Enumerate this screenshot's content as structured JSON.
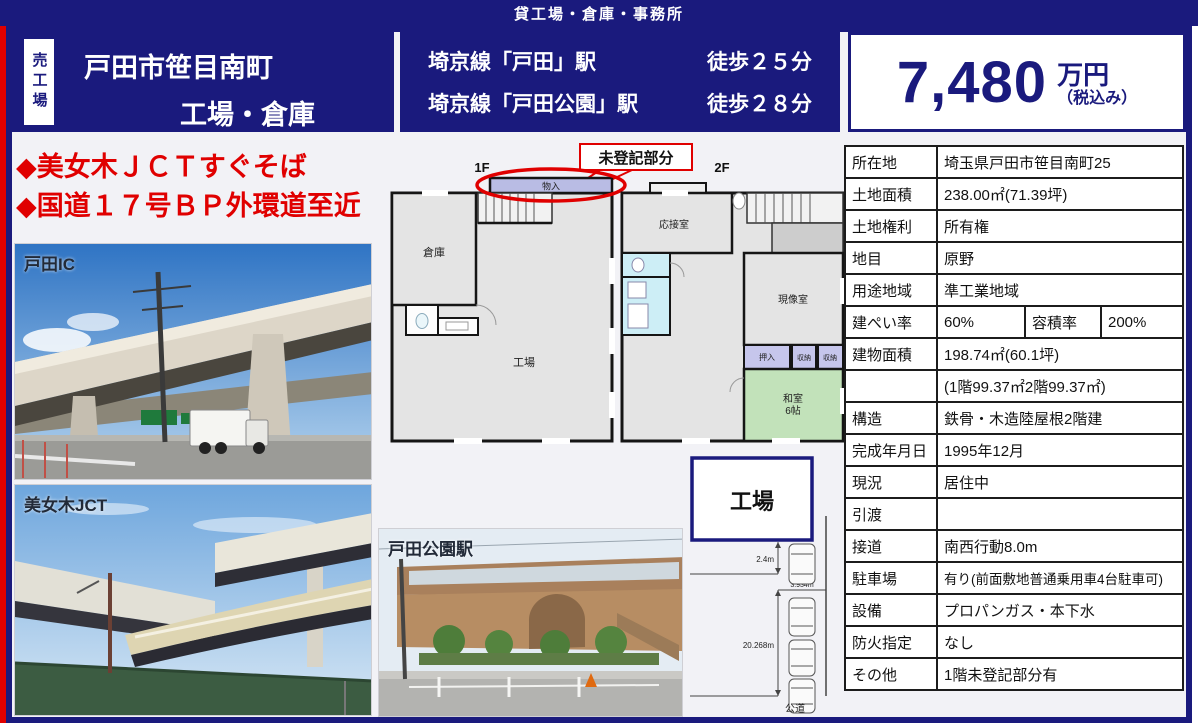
{
  "banner": {
    "text": "貸工場・倉庫・事務所"
  },
  "header": {
    "side_tag": "売工場",
    "title_line1": "戸田市笹目南町",
    "title_line2": "工場・倉庫",
    "stations": [
      {
        "line": "埼京線「戸田」駅",
        "walk": "徒歩２５分"
      },
      {
        "line": "埼京線「戸田公園」駅",
        "walk": "徒歩２８分"
      }
    ],
    "price": {
      "amount": "7,480",
      "unit": "万円",
      "tax_note": "（税込み）"
    }
  },
  "headlines": {
    "line1": "◆美女木ＪＣＴすぐそば",
    "line2": "◆国道１７号ＢＰ外環道至近"
  },
  "photos": {
    "photo1_label": "戸田IC",
    "photo2_label": "美女木JCT",
    "photo3_label": "戸田公園駅"
  },
  "floorplan": {
    "annotation": "未登記部分",
    "floor1_label": "1F",
    "floor2_label": "2F",
    "rooms": {
      "monoire": "物入",
      "soko": "倉庫",
      "kojo": "工場",
      "osetsu": "応接室",
      "genzo": "現像室",
      "oshiire": "押入",
      "shuno1": "収納",
      "shuno2": "収納",
      "washitsu1": "和室",
      "washitsu2": "6帖"
    }
  },
  "site_diagram": {
    "building": "工場",
    "dim_side": "2.4m",
    "dim_front": "3.934m",
    "dim_depth": "20.268m",
    "road": "公道"
  },
  "table": {
    "rows": [
      {
        "label": "所在地",
        "value": "埼玉県戸田市笹目南町25"
      },
      {
        "label": "土地面積",
        "value": "238.00㎡(71.39坪)"
      },
      {
        "label": "土地権利",
        "value": "所有権"
      },
      {
        "label": "地目",
        "value": "原野"
      },
      {
        "label": "用途地域",
        "value": "準工業地域"
      },
      {
        "label": "建物面積",
        "value": "198.74㎡(60.1坪)"
      },
      {
        "label": "",
        "value": "(1階99.37㎡2階99.37㎡)"
      },
      {
        "label": "構造",
        "value": "鉄骨・木造陸屋根2階建"
      },
      {
        "label": "完成年月日",
        "value": "1995年12月"
      },
      {
        "label": "現況",
        "value": "居住中"
      },
      {
        "label": "引渡",
        "value": ""
      },
      {
        "label": "接道",
        "value": "南西行動8.0m"
      },
      {
        "label": "駐車場",
        "value": "有り(前面敷地普通乗用車4台駐車可)"
      },
      {
        "label": "設備",
        "value": "プロパンガス・本下水"
      },
      {
        "label": "防火指定",
        "value": "なし"
      },
      {
        "label": "その他",
        "value": "1階未登記部分有"
      }
    ],
    "ratio_row": {
      "label1": "建ぺい率",
      "value1": "60%",
      "label2": "容積率",
      "value2": "200%"
    }
  },
  "colors": {
    "navy": "#1a1a7d",
    "red": "#e00000"
  }
}
